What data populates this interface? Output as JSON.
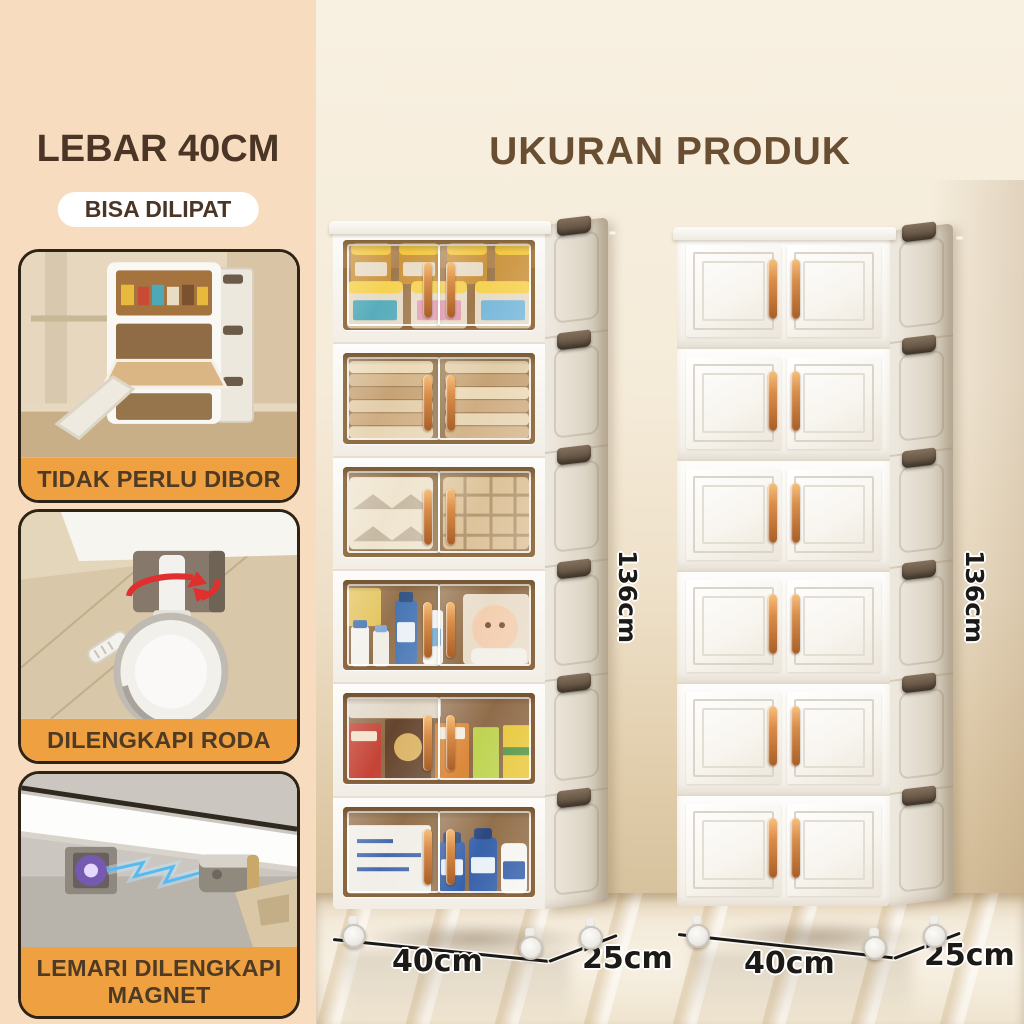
{
  "sidebar": {
    "title": "LEBAR 40CM",
    "badge": "BISA DILIPAT",
    "features": [
      {
        "label": "TIDAK PERLU DIBOR",
        "image": "cabinet-open-flip-doors-photo"
      },
      {
        "label": "DILENGKAPI RODA",
        "image": "swivel-caster-wheel-photo"
      },
      {
        "label": "LEMARI DILENGKAPI MAGNET",
        "image": "magnetic-latch-closeup-photo"
      }
    ]
  },
  "main": {
    "title": "UKURAN PRODUK",
    "cabinets": [
      {
        "name": "six-tier-folding-cabinet-transparent-doors",
        "height_label": "136cm",
        "width_label": "40cm",
        "depth_label": "25cm",
        "tier_contents": [
          "milk-formula-tins",
          "folded-towels",
          "folded-blankets",
          "baby-care-products",
          "snack-boxes",
          "bottled-drinks"
        ]
      },
      {
        "name": "six-tier-folding-cabinet-closed-doors",
        "height_label": "136cm",
        "width_label": "40cm",
        "depth_label": "25cm"
      }
    ]
  },
  "colors": {
    "sidebar_bg": "#F8DCBF",
    "accent_orange": "#EFA041",
    "heading_brown": "#4A3526",
    "main_title_brown": "#6A4E32",
    "card_border": "#2E2315",
    "dimension_black": "#1C1A17",
    "handle_copper": "#D98E4A",
    "clip_brown": "#6E5D4B",
    "wall_cream": "#F6EEDE",
    "wall_tan": "#CDB590"
  }
}
